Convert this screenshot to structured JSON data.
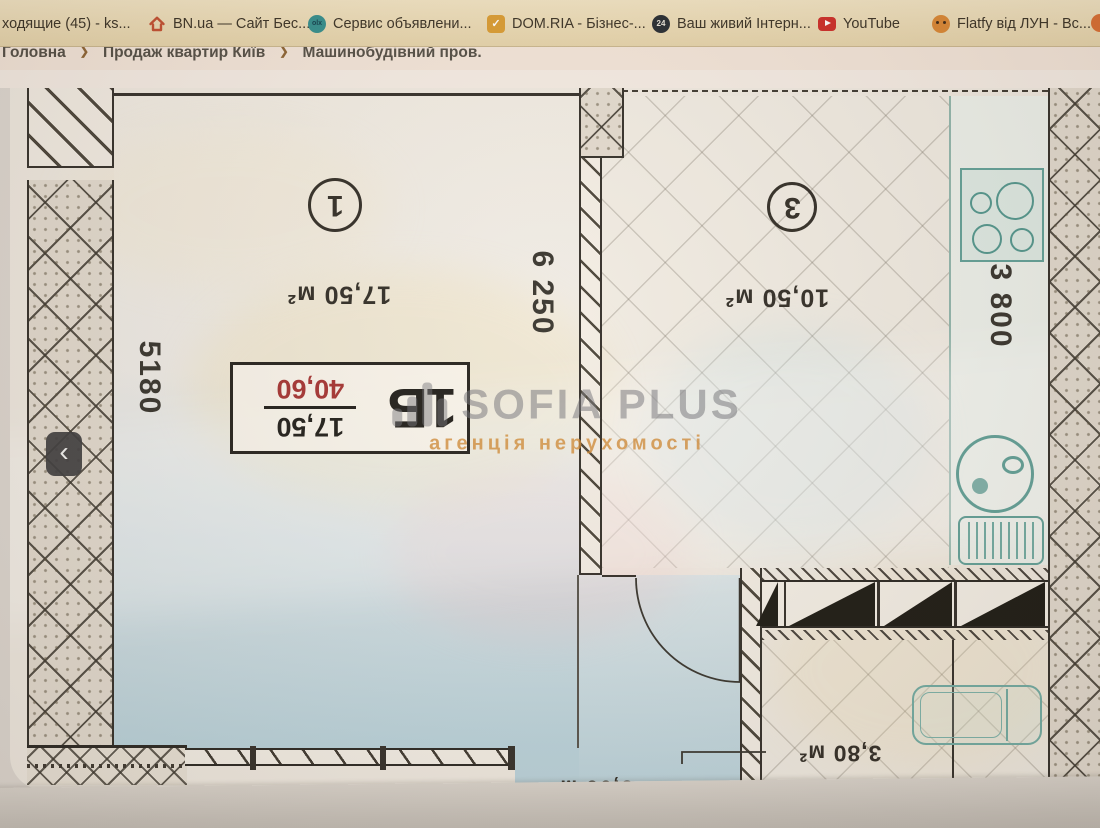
{
  "bookmarks_bar": {
    "items": [
      {
        "label": "ходящие (45) - ks..."
      },
      {
        "label": "BN.ua — Сайт Бес..."
      },
      {
        "label": "Сервис объявлени...",
        "icon_text": "olx"
      },
      {
        "label": "DOM.RIA - Бізнес-...",
        "icon_text": "✓"
      },
      {
        "label": "Ваш живий Інтерн...",
        "badge": "24"
      },
      {
        "label": "YouTube"
      },
      {
        "label": "Flatfy від ЛУН - Вс..."
      }
    ]
  },
  "breadcrumb": {
    "home": "Головна",
    "level2": "Продаж квартир Київ",
    "level3": "Машинобудівний пров.",
    "separator": "❯"
  },
  "gallery": {
    "prev": "‹"
  },
  "plan": {
    "room1": {
      "number": "1",
      "area": "17,50 м²",
      "width_mm": "5180",
      "depth_mm": "6 250"
    },
    "room3": {
      "number": "3",
      "area": "10,50 м²",
      "width_mm": "3 800"
    },
    "bathroom": {
      "area": "3,80 м²",
      "dim_partial": "2"
    },
    "hall": {
      "area_partial": "5,00 м²"
    },
    "stamp": {
      "type": "1Б",
      "living_area": "17,50",
      "total_area": "40,60"
    },
    "watermark": {
      "title": "SOFIA PLUS",
      "subtitle": "агенція нерухомості"
    }
  }
}
